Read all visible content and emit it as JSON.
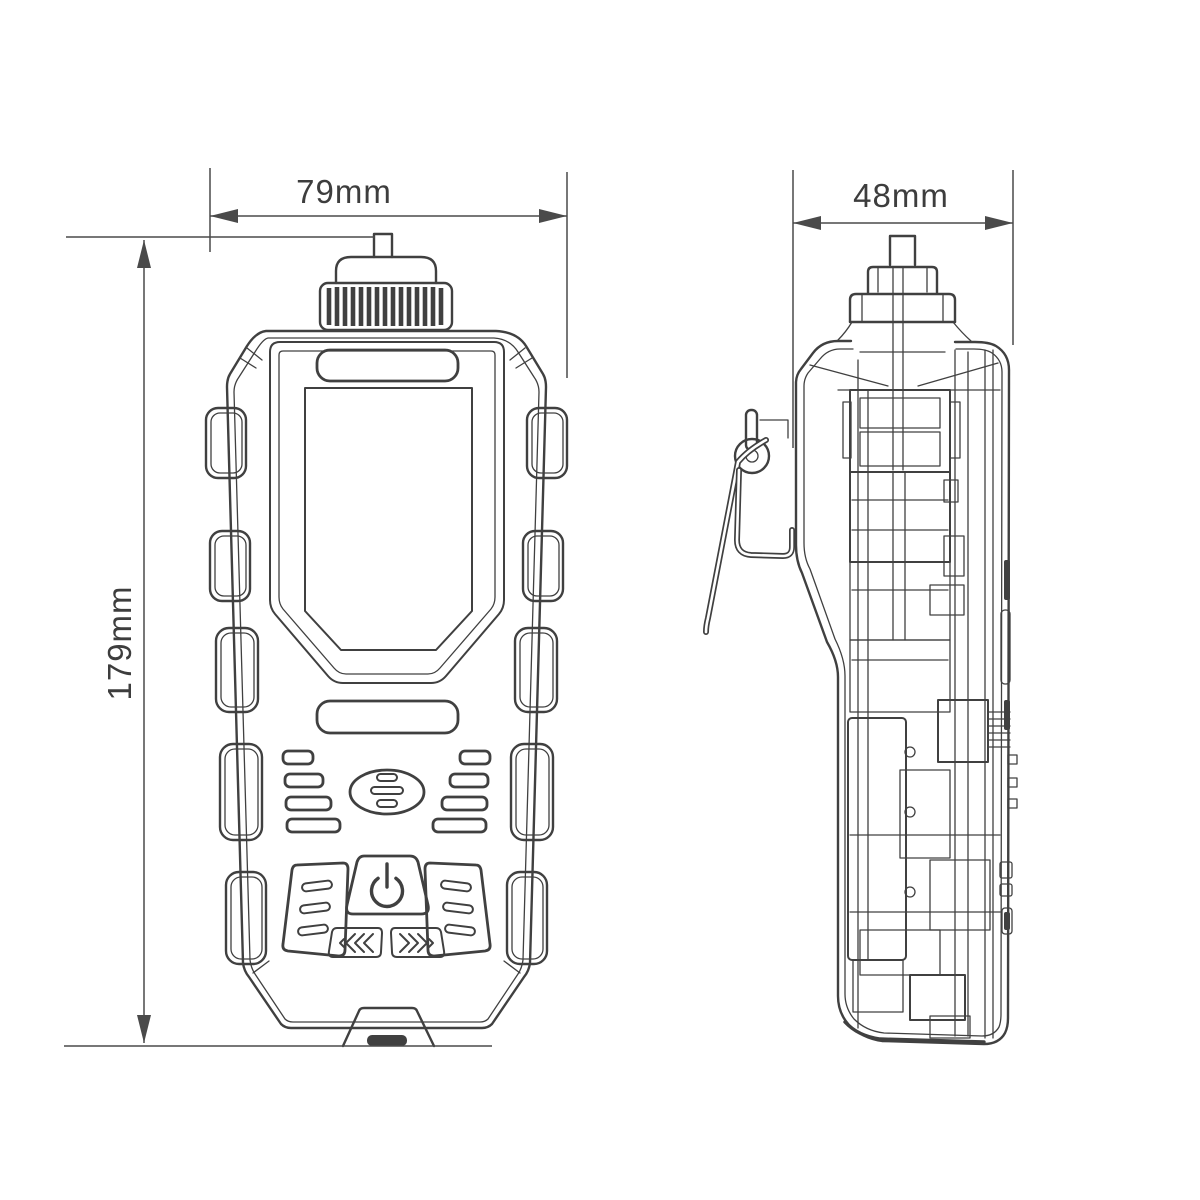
{
  "diagram": {
    "type": "technical-dimension-drawing",
    "subject": "handheld portable gas detector, front and side orthographic views",
    "views": [
      {
        "id": "front",
        "label": "front-view"
      },
      {
        "id": "side",
        "label": "side-view"
      }
    ],
    "dimensions": {
      "width_front": "79mm",
      "depth_side": "48mm",
      "height": "179mm"
    },
    "icons": {
      "power_icon": "⏻",
      "chevrons_left_icon": "⟨⟨⟨",
      "chevrons_right_icon": "⟩⟩⟩"
    },
    "colors": {
      "line_color": "#404040",
      "dim_color": "#4a4a4a",
      "text_color": "#3d3d3d",
      "bg_color": "#ffffff"
    }
  }
}
